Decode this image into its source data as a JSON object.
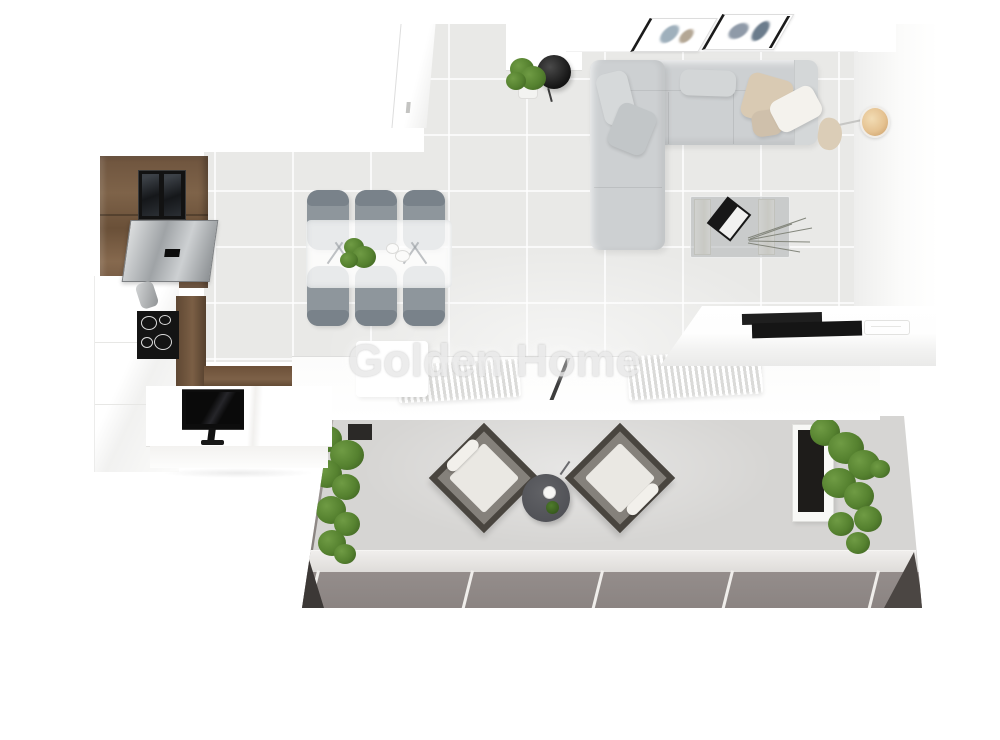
{
  "image": {
    "title": "Top-view 3D apartment floor plan rendering",
    "watermark": "Golden Home"
  },
  "colors": {
    "floor": "#e9e9e7",
    "sofa": "#cdd0d2",
    "sofa-light": "#d6d9da",
    "chair-gray": "#8e969c",
    "chair-dark": "#79828a",
    "beige": "#d9cab3",
    "cream": "#f4f2ed",
    "lamp-shade": "#e5c291",
    "green": "#55812f",
    "green-dark": "#3a5c1f",
    "balcony-floor": "#d6d5d3",
    "balcony-dark": "#8b8482",
    "corner-dark": "#3c3836",
    "side-table": "#515257",
    "watermark": "#e9e9e9"
  },
  "objects": {
    "living_room": [
      "sectional-sofa",
      "throw-pillows",
      "beige-throw",
      "coffee-table",
      "decor-book",
      "dried-twigs",
      "arc-floor-lamp",
      "wall-art-frames",
      "potted-plant",
      "black-stool",
      "closet-door"
    ],
    "dining_area": {
      "table": "glass-dining-table",
      "chairs_count": 6,
      "decor": [
        "centerpiece-plant",
        "plates"
      ]
    },
    "kitchen": [
      "wood-tall-cabinets",
      "built-in-oven",
      "steel-appliance",
      "induction-cooktop",
      "faucet",
      "wood-countertop",
      "white-cabinets",
      "peninsula-counter",
      "countertop-tv"
    ],
    "island": [
      "white-counter",
      "black-cooktop"
    ],
    "window_wall": {
      "radiators_count": 2,
      "items": [
        "radiator-left",
        "radiator-right",
        "window-frame-divider",
        "white-sideboard"
      ]
    },
    "balcony": {
      "armchairs_count": 2,
      "items": [
        "planter-left",
        "planter-right",
        "armchair-left",
        "armchair-right",
        "round-side-table",
        "coffee-cup",
        "mini-plant",
        "step-edge",
        "dark-floor-tiles"
      ]
    }
  }
}
